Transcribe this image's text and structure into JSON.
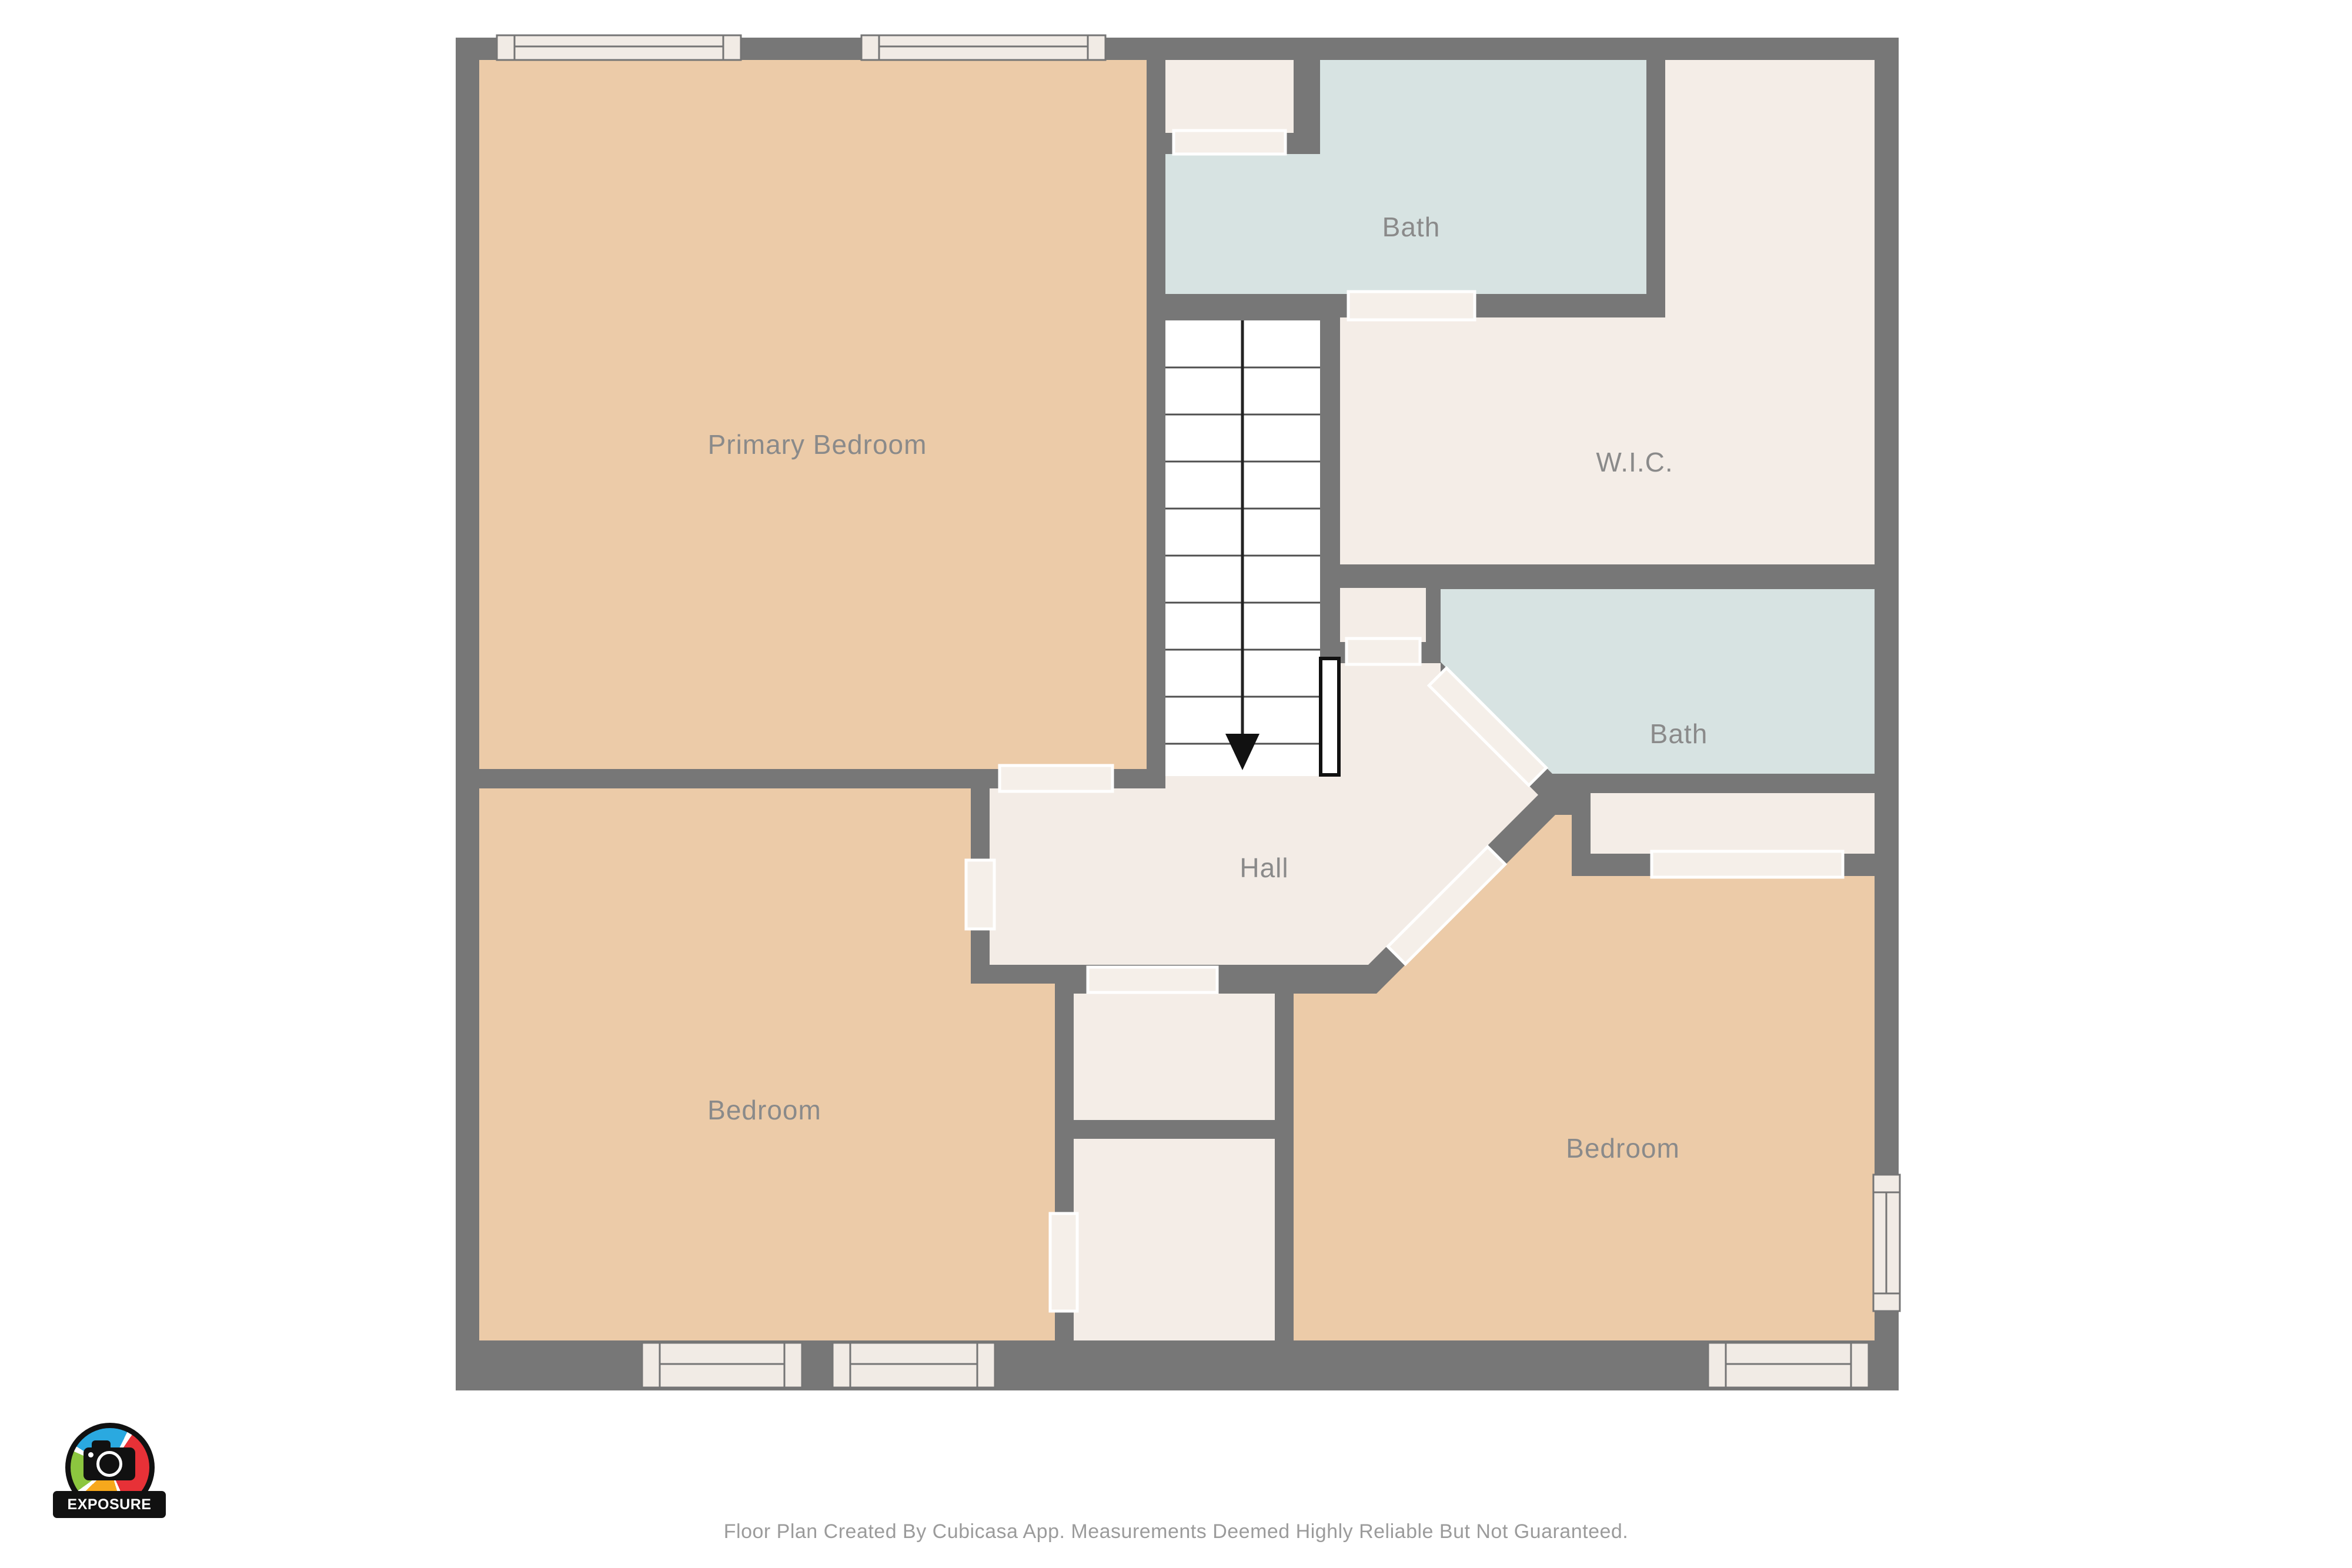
{
  "rooms": [
    {
      "id": "primary-bedroom",
      "label": "Primary Bedroom"
    },
    {
      "id": "bath-top",
      "label": "Bath"
    },
    {
      "id": "wic",
      "label": "W.I.C."
    },
    {
      "id": "bath-right",
      "label": "Bath"
    },
    {
      "id": "hall",
      "label": "Hall"
    },
    {
      "id": "bedroom-left",
      "label": "Bedroom"
    },
    {
      "id": "bedroom-right",
      "label": "Bedroom"
    }
  ],
  "stairs": {
    "arrow_icon": "arrow-down",
    "direction": "down"
  },
  "logo": {
    "brand": "EXPOSURE MEDIA"
  },
  "footer": {
    "disclaimer": "Floor Plan Created By Cubicasa App. Measurements Deemed Highly Reliable But Not Guaranteed."
  },
  "colors": {
    "wall": "#777777",
    "bedroom_fill": "#ECCBA8",
    "bath_fill": "#D7E3E2",
    "closet_fill": "#F4EDE7",
    "stairs_fill": "#FFFFFF",
    "door_opening": "#F5EFE9",
    "window_fill": "#F1EBE5",
    "label_text": "#8A8A8A",
    "disclaimer_text": "#9B9B9B",
    "logo_blue": "#2AA9E0",
    "logo_red": "#E73137",
    "logo_orange": "#F6A81C",
    "logo_green": "#8CC63F"
  }
}
